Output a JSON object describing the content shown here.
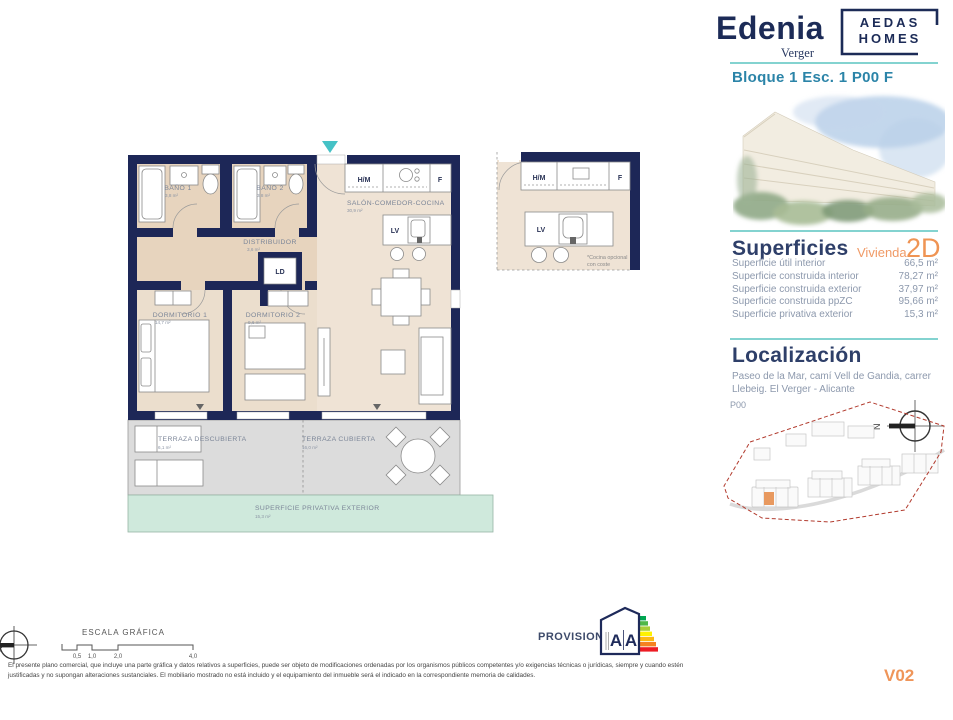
{
  "header": {
    "brand": "Edenia",
    "brand_sub": "Verger",
    "logo_line1": "AEDAS",
    "logo_line2": "HOMES",
    "block_ref": "Bloque 1 Esc. 1 P00 F"
  },
  "superficies": {
    "title": "Superficies",
    "unit_label": "Vivienda",
    "unit_code": "2D",
    "rows": [
      {
        "label": "Superficie útil interior",
        "value": "66,5 m²"
      },
      {
        "label": "Superficie construida interior",
        "value": "78,27 m²"
      },
      {
        "label": "Superficie construida exterior",
        "value": "37,97 m²"
      },
      {
        "label": "Superficie construida ppZC",
        "value": "95,66 m²"
      },
      {
        "label": "Superficie privativa exterior",
        "value": "15,3 m²"
      }
    ]
  },
  "localizacion": {
    "title": "Localización",
    "address": "Paseo de la Mar, camí Vell de Gandia, carrer Llebeig. El Verger - Alicante",
    "floor_label": "P00",
    "compass_letter": "N"
  },
  "plan": {
    "rooms": {
      "bano1": {
        "name": "BAÑO 1",
        "area": "3,8 m²"
      },
      "bano2": {
        "name": "BAÑO 2",
        "area": "3,8 m²"
      },
      "distribuidor": {
        "name": "DISTRIBUIDOR",
        "area": "3,6 m²"
      },
      "ld": "LD",
      "salon": {
        "name": "SALÓN-COMEDOR-COCINA",
        "area": "30,9 m²"
      },
      "dorm1": {
        "name": "DORMITORIO 1",
        "area": "14,7 m²"
      },
      "dorm2": {
        "name": "DORMITORIO 2",
        "area": "9,6 m²"
      },
      "terraza_descubierta": {
        "name": "TERRAZA DESCUBIERTA",
        "area": "6,1 m²"
      },
      "terraza_cubierta": {
        "name": "TERRAZA CUBIERTA",
        "area": "16,0 m²"
      },
      "privativa": {
        "name": "SUPERFICIE PRIVATIVA EXTERIOR",
        "area": "15,3 m²"
      }
    },
    "labels": {
      "hm": "H/M",
      "f": "F",
      "lv": "LV"
    },
    "inset": {
      "note1": "*Cocina opcional",
      "note2": "con coste"
    }
  },
  "footer": {
    "scale_title": "ESCALA GRÁFICA",
    "scale_ticks": [
      "0,5",
      "1,0",
      "2,0",
      "4,0"
    ],
    "provisional": "PROVISIONAL",
    "energy_letters": [
      "A",
      "A"
    ],
    "disclaimer": "El presente plano comercial, que incluye una parte gráfica y datos relativos a superficies, puede ser objeto de modificaciones ordenadas por los organismos públicos competentes y/o exigencias técnicas o jurídicas, siempre y cuando estén justificadas y no supongan alteraciones sustanciales. El mobiliario mostrado no está incluido y el equipamiento del inmueble será el indicado en la correspondiente memoria de calidades.",
    "version": "V02"
  },
  "colors": {
    "wall_navy": "#1d2757",
    "teal_rule": "#83d3d0",
    "accent_orange": "#ef9559",
    "ref_blue": "#2b84a8",
    "floor_beige": "#ecdfd0",
    "terrace_gray": "#dcdcdc",
    "exterior_green": "#cfe9dc",
    "site_boundary_red": "#b23b2e"
  }
}
